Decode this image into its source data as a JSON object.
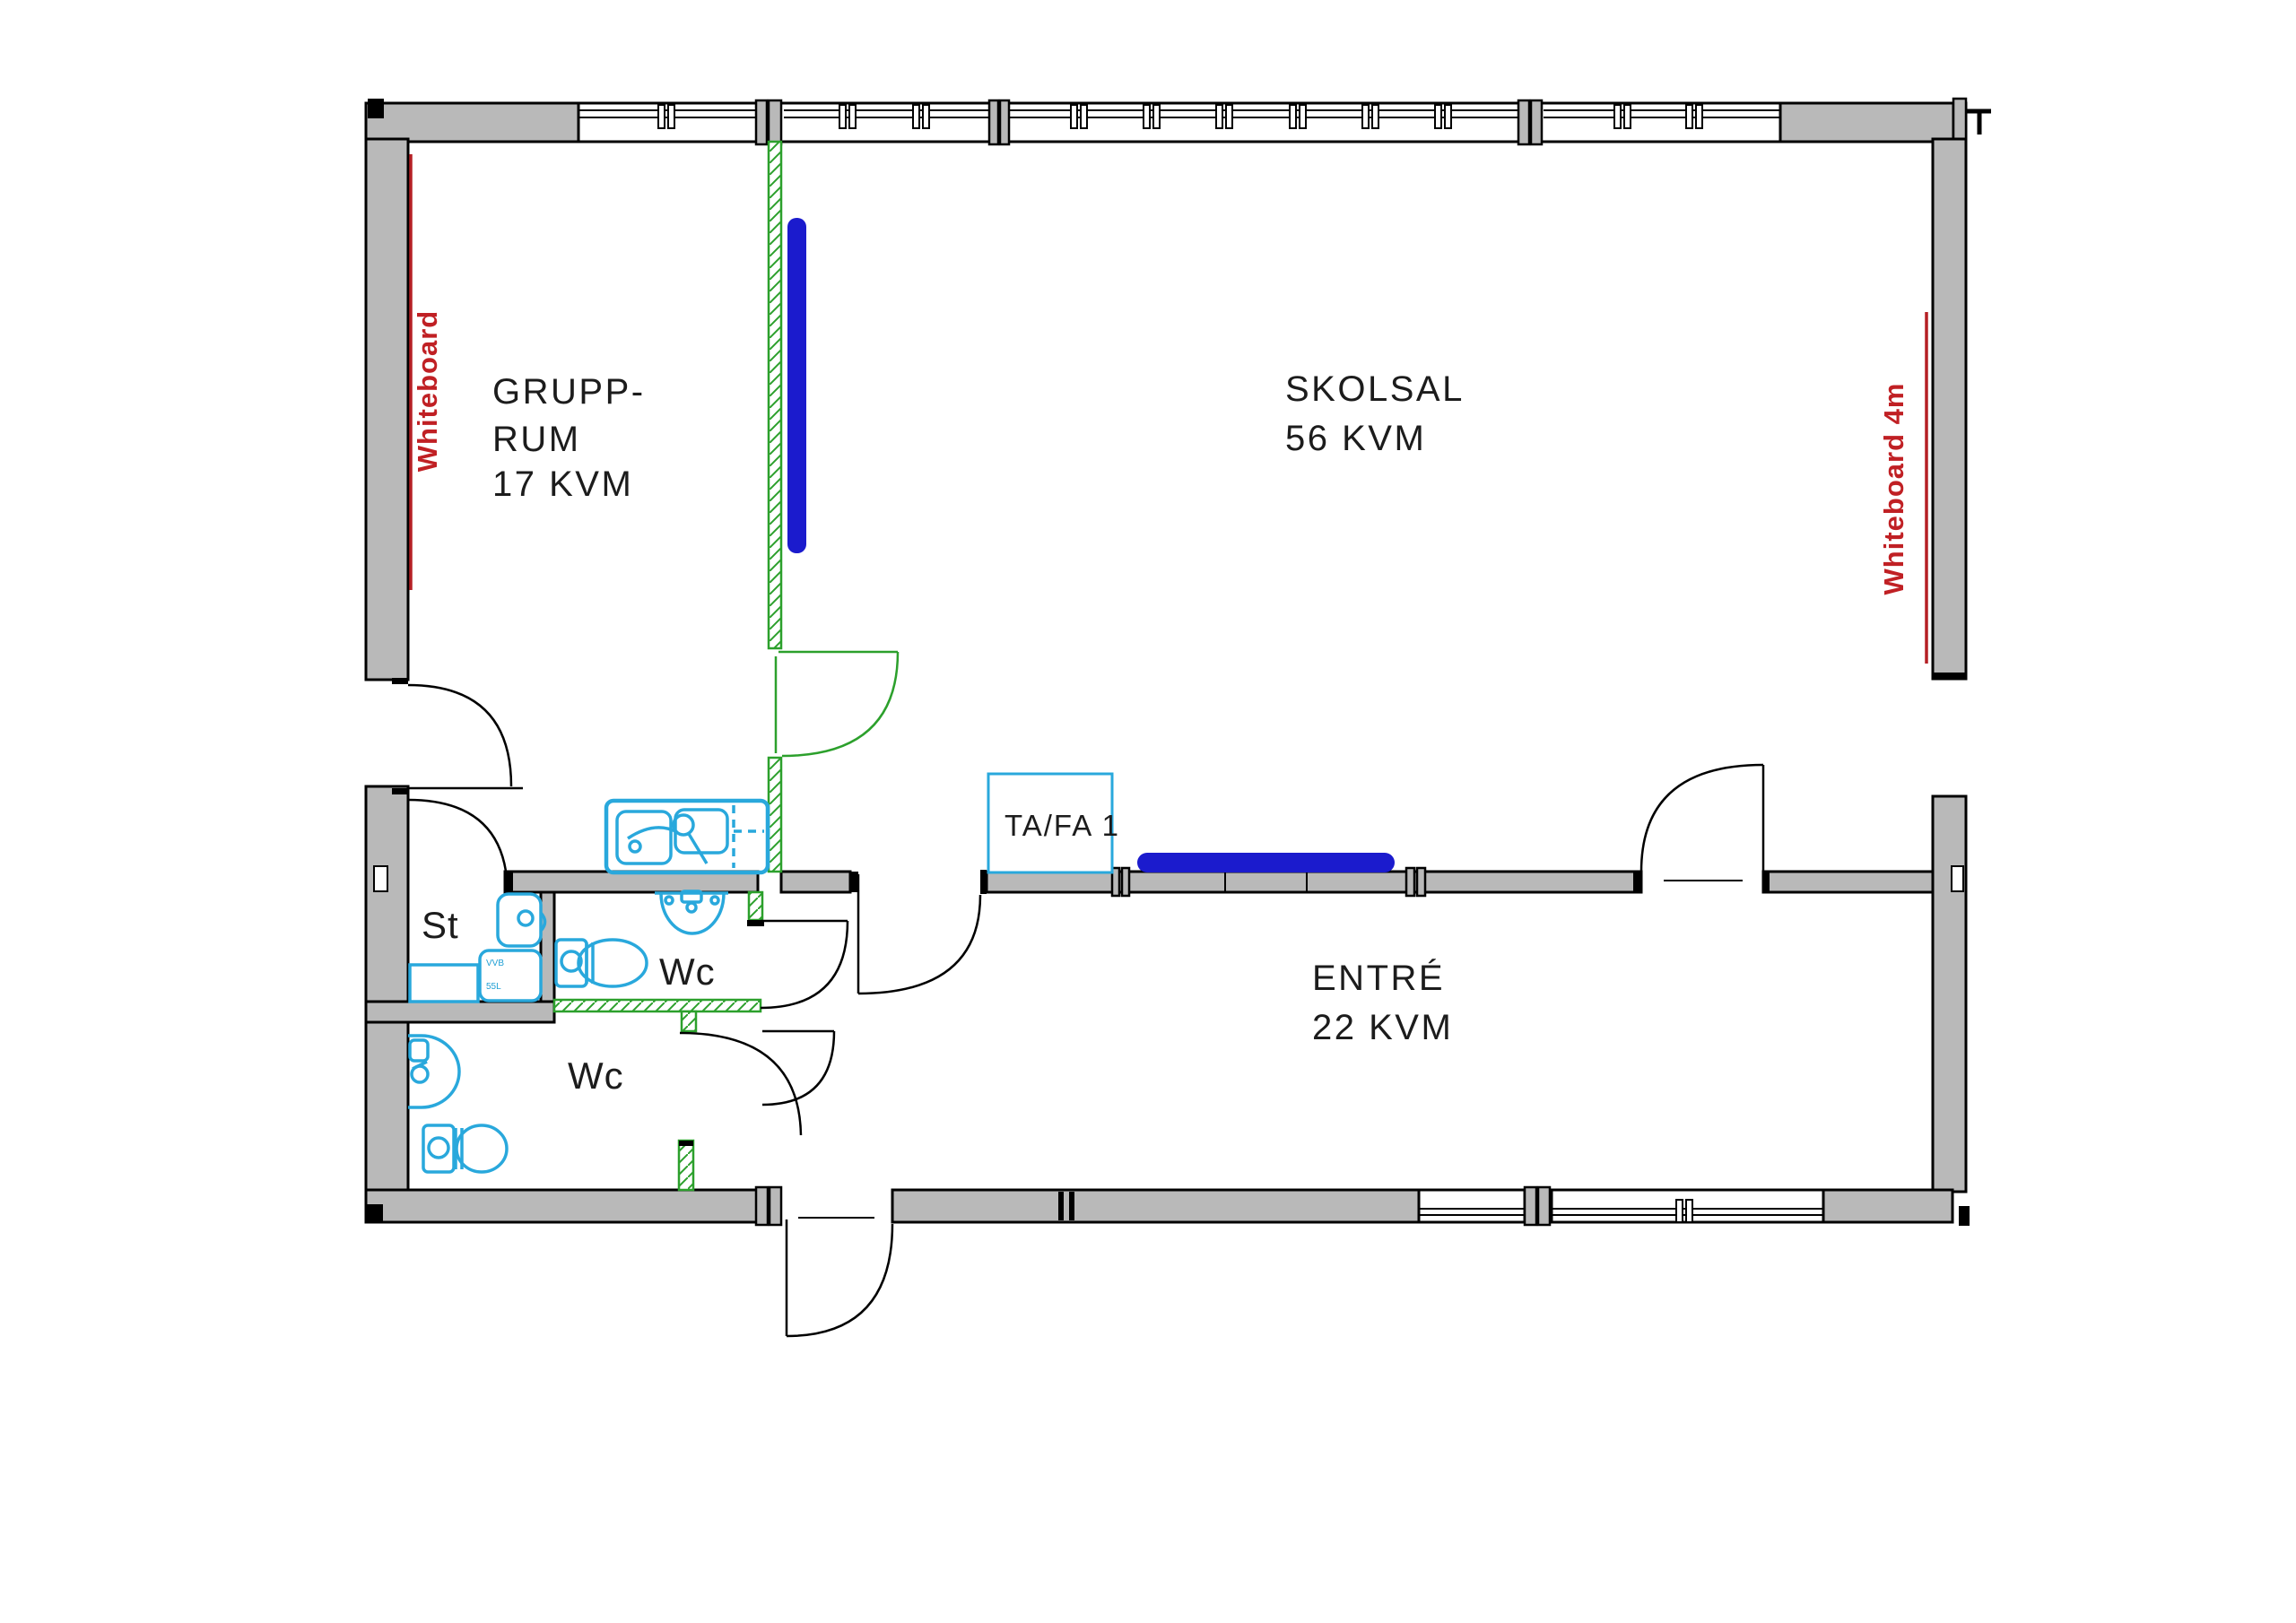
{
  "rooms": {
    "grupp": {
      "line1": "GRUPP-",
      "line2": "RUM",
      "area": "17 KVM"
    },
    "skolsal": {
      "name": "SKOLSAL",
      "area": "56 KVM"
    },
    "entre": {
      "name": "ENTRÉ",
      "area": "22 KVM"
    },
    "wc_upper": {
      "name": "Wc"
    },
    "wc_lower": {
      "name": "Wc"
    },
    "st": {
      "name": "St"
    }
  },
  "equipment": {
    "tafa": {
      "label": "TA/FA 1"
    },
    "water_heater": {
      "line1": "VVB",
      "line2": "55L"
    },
    "whiteboard_left": {
      "label": "Whiteboard"
    },
    "whiteboard_right": {
      "label": "Whiteboard 4m"
    }
  },
  "colors": {
    "wall_fill": "#b9b9b9",
    "outline": "#000000",
    "demolition_green": "#2ca02c",
    "plumbing_cyan": "#29a8dc",
    "whiteboard_blue": "#1b1bcd",
    "annotation_red": "#c02024",
    "label_text": "#1c1c1c"
  }
}
